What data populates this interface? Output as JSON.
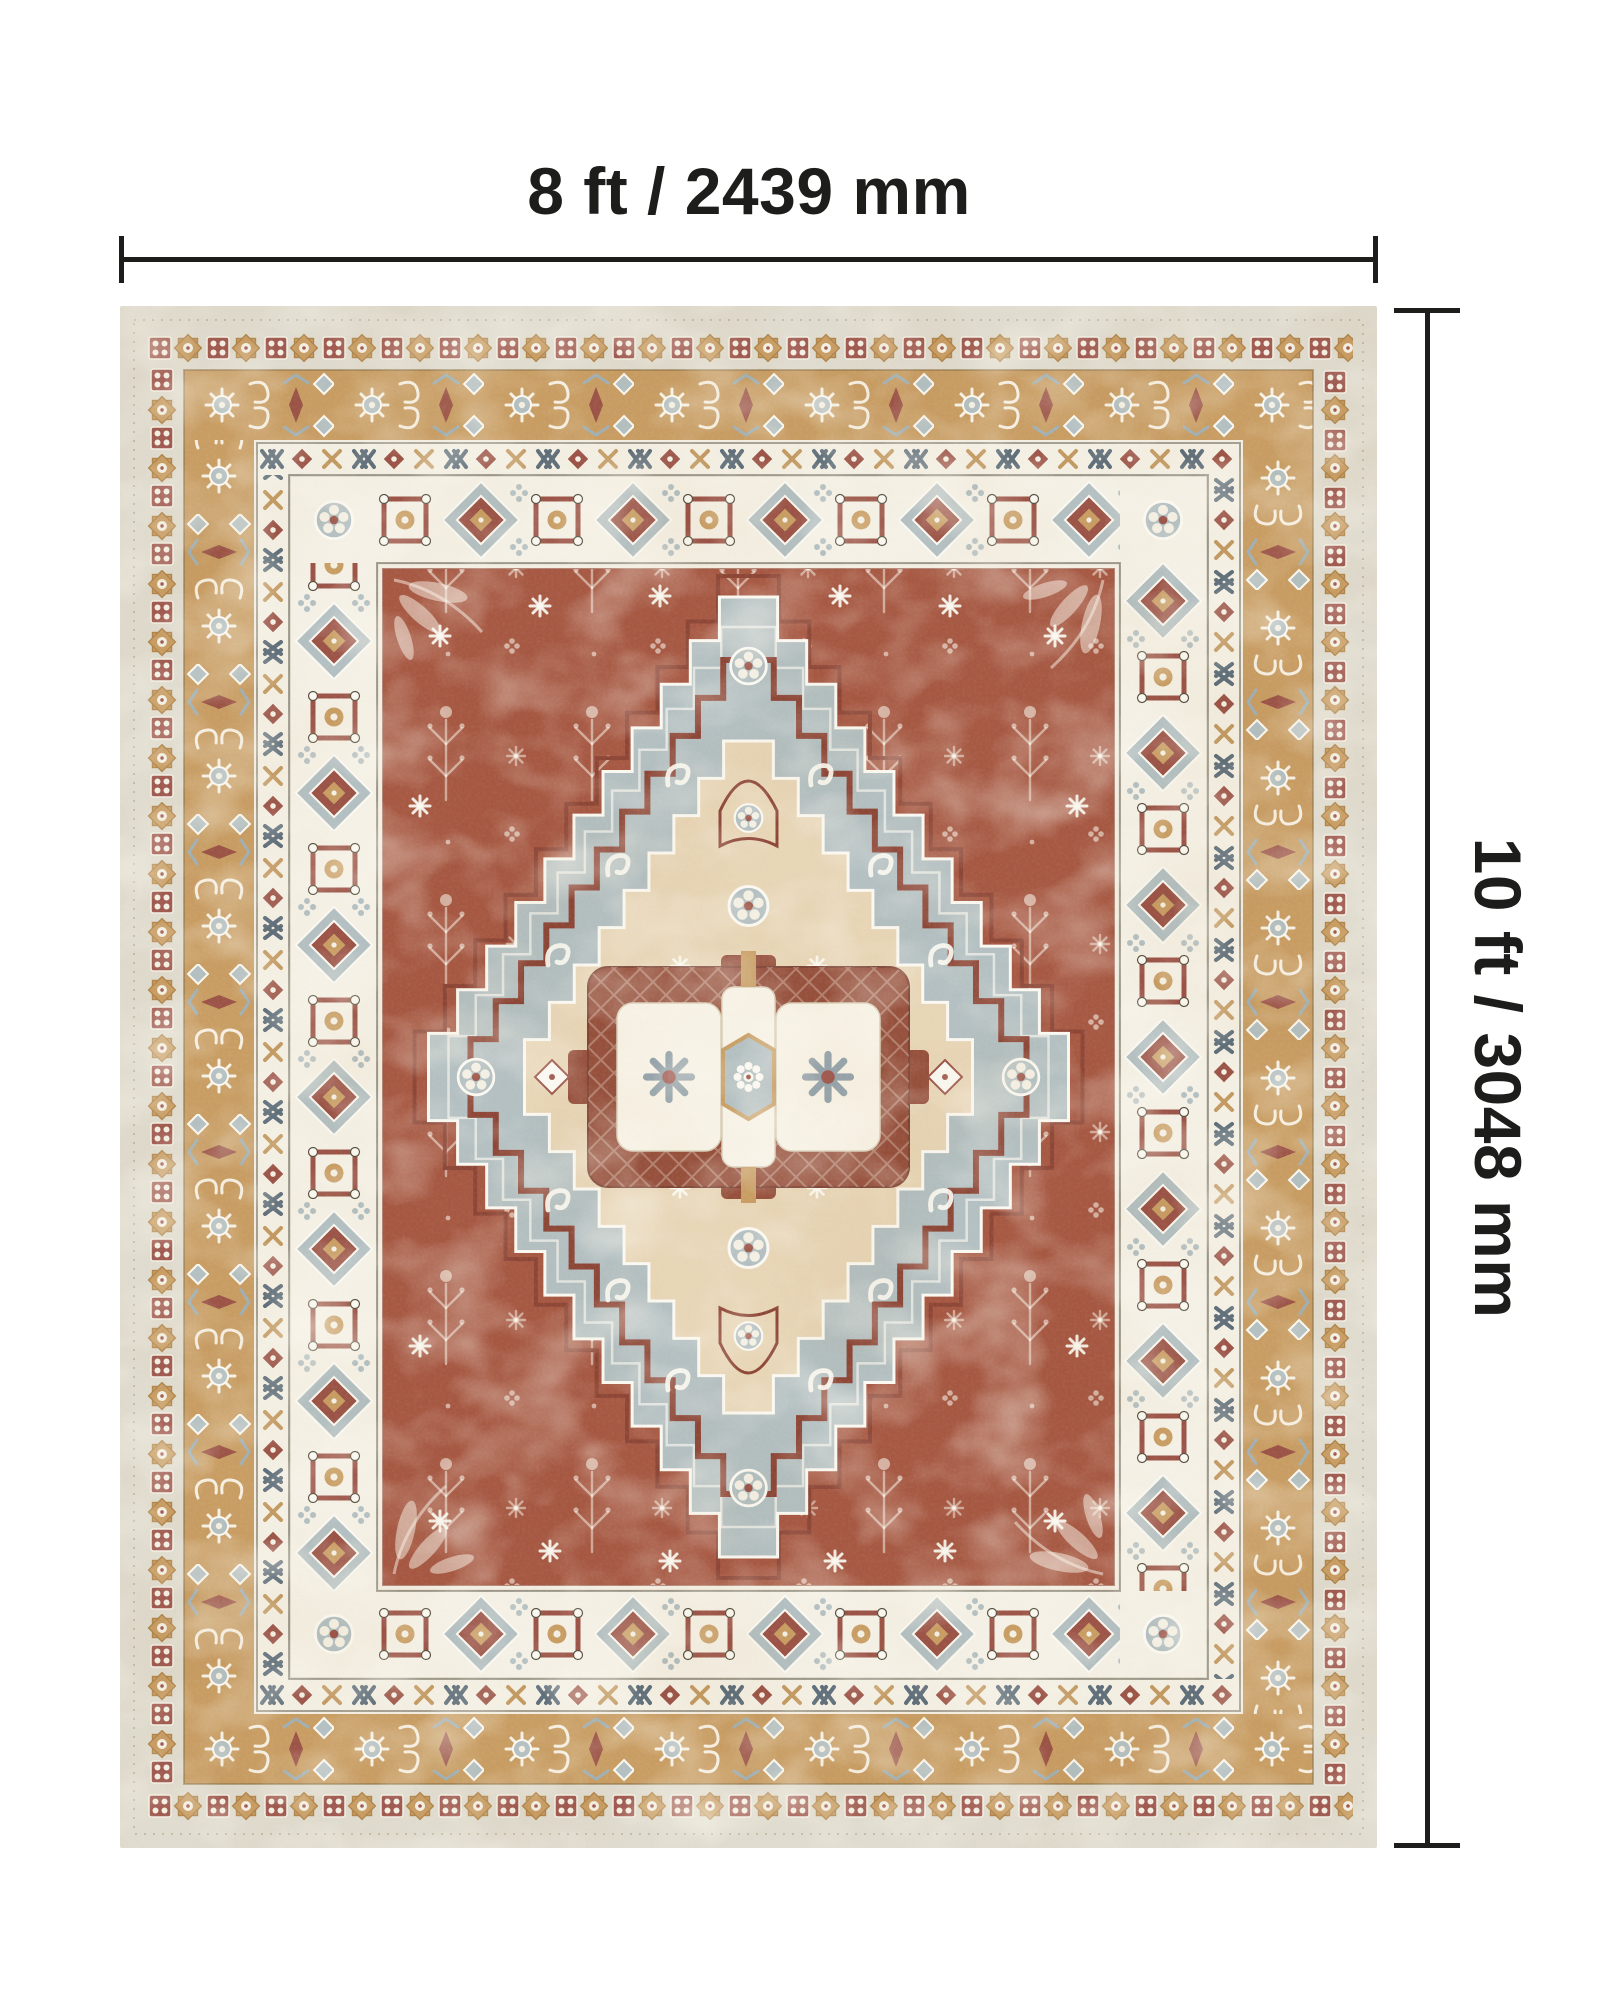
{
  "annotations": {
    "width_label": "8 ft / 2439 mm",
    "height_label": "10 ft / 3048 mm"
  },
  "colors": {
    "page_background": "#ffffff",
    "dimension_line": "#1d1d1b",
    "greige": "#dfdbce",
    "maroon": "#9b5346",
    "tan": "#c89d63",
    "cream": "#f3efe3",
    "rust": "#a65842",
    "bluegray": "#b3bfc1",
    "cream_diamond": "#e7d5b6",
    "center_rust": "#96503c",
    "band_white": "#f4f0e5"
  }
}
